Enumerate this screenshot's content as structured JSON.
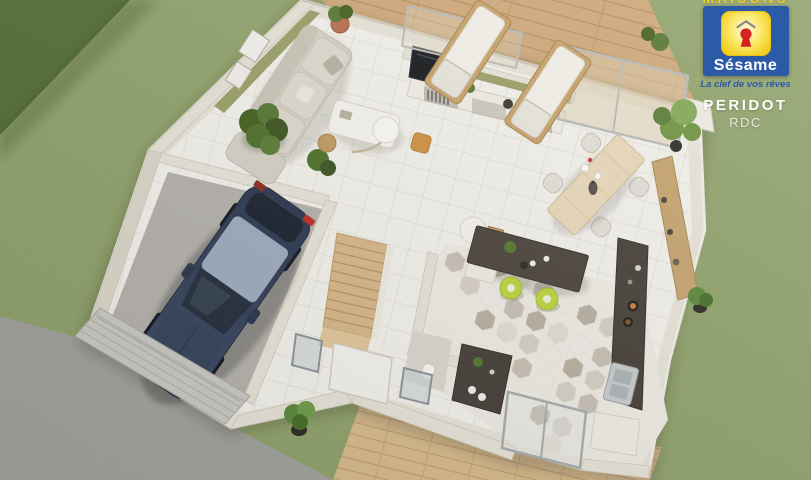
{
  "logo": {
    "brand_top_clipped": "MAISONS",
    "brand": "Sésame",
    "tagline": "La clef de vos rêves",
    "plan_name": "PERIDOT",
    "level": "RDC"
  },
  "icons": {
    "logo_mark": "keyhole-house-icon"
  },
  "colors": {
    "brand_blue": "#2b5aa6",
    "brand_yellow": "#f6d01f",
    "brand_red": "#d42222",
    "grass_green": "#94a471",
    "hedge_green": "#4c662f",
    "accent_olive": "#9aa069",
    "deck_wood": "#cfa87a",
    "stair_wood": "#d9b88a",
    "wall_cream": "#e8e4d9",
    "counter_charcoal": "#47403a",
    "stool_lime": "#bcd63f",
    "car_navy": "#37455c",
    "gravel_gray": "#9c9c98"
  }
}
